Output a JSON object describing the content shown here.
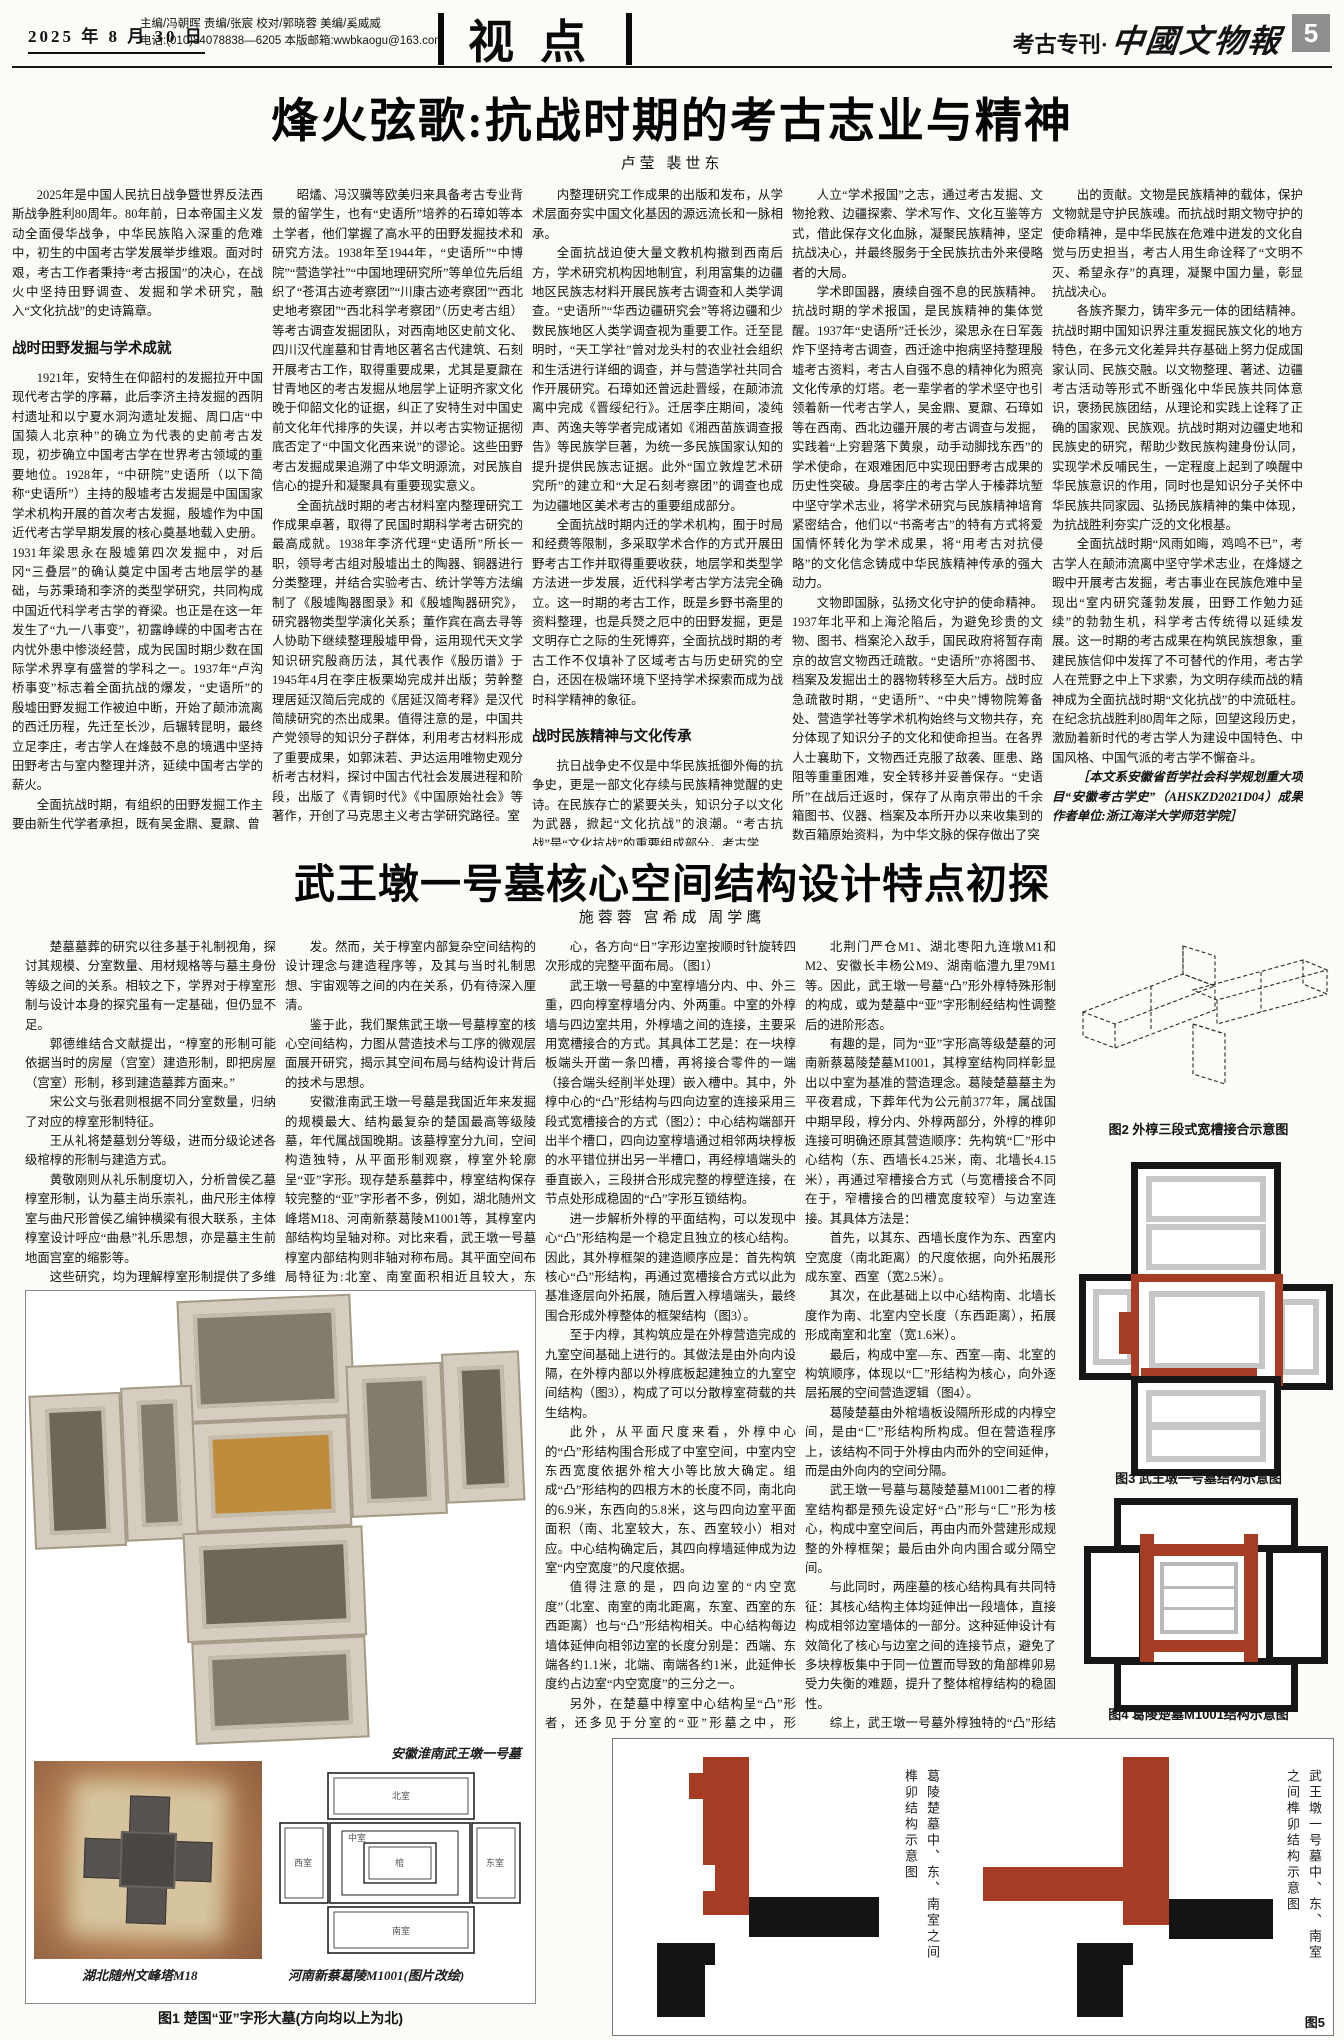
{
  "colors": {
    "accent_red": "#a63c24",
    "ink": "#131313",
    "page_badge_bg": "#8f8f8f"
  },
  "header": {
    "date": "2025 年 8 月 30 日",
    "editors": "主编/冯朝晖 责编/张宸 校对/郭晓蓉 美编/奚威威",
    "contact": "电话:(010)84078838—6205 本版邮箱:wwbkaogu@163.com",
    "section": "视点",
    "edition": "考古专刊·",
    "paper": "中國文物報",
    "page_no": "5"
  },
  "article1": {
    "title": "烽火弦歌:抗战时期的考古志业与精神",
    "authors": "卢莹  裴世东",
    "heading1": "战时田野发掘与学术成就",
    "heading2": "战时民族精神与文化传承",
    "c1": {
      "p1": "2025年是中国人民抗日战争暨世界反法西斯战争胜利80周年。80年前，日本帝国主义发动全面侵华战争，中华民族陷入深重的危难中，初生的中国考古学发展举步维艰。面对时艰，考古工作者秉持“考古报国”的决心，在战火中坚持田野调查、发掘和学术研究，融入“文化抗战”的史诗篇章。",
      "p2": "1921年，安特生在仰韶村的发掘拉开中国现代考古学的序幕，此后李济主持发掘的西阴村遗址和以宁夏水洞沟遗址发掘、周口店“中国猿人北京种”的确立为代表的史前考古发现，初步确立中国考古学在世界考古领域的重要地位。1928年，“中研院”史语所（以下简称“史语所”）主持的殷墟考古发掘是中国国家学术机构开展的首次考古发掘，殷墟作为中国近代考古学早期发展的核心奠基地载入史册。1931年梁思永在殷墟第四次发掘中，对后冈“三叠层”的确认奠定中国考古地层学的基础，与苏秉琦和李济的类型学研究，共同构成中国近代科学考古学的脊梁。也正是在这一年发生了“九一八事变”，初露峥嵘的中国考古在内忧外患中惨淡经营，成为民国时期少数在国际学术界享有盛誉的学科之一。1937年“卢沟桥事变”标志着全面抗战的爆发，“史语所”的殷墟田野发掘工作被迫中断，开始了颠沛流离的西迁历程，先迁至长沙，后辗转昆明，最终立足李庄，考古学人在烽鼓不息的境遇中坚持田野考古与室内整理并济，延续中国考古学的薪火。",
      "p3": "全面抗战时期，有组织的田野发掘工作主要由新生代学者承担，既有吴金鼎、夏鼐、曾"
    },
    "c2": {
      "p1": "昭燏、冯汉骥等欧美归来具备考古专业背景的留学生，也有“史语所”培养的石璋如等本土学者，他们掌握了高水平的田野发掘技术和研究方法。1938年至1944年，“史语所”“中博院”“营造学社”“中国地理研究所”等单位先后组织了“苍洱古迹考察团”“川康古迹考察团”“西北史地考察团”“西北科学考察团”（历史考古组）等考古调查发掘团队，对西南地区史前文化、四川汉代崖墓和甘青地区著名古代建筑、石刻开展考古工作，取得重要成果，尤其是夏鼐在甘青地区的考古发掘从地层学上证明齐家文化晚于仰韶文化的证据，纠正了安特生对中国史前文化年代排序的失误，并以考古实物证据彻底否定了“中国文化西来说”的谬论。这些田野考古发掘成果追溯了中华文明源流，对民族自信心的提升和凝聚具有重要现实意义。",
      "p2": "全面抗战时期的考古材料室内整理研究工作成果卓著，取得了民国时期科学考古研究的最高成就。1938年李济代理“史语所”所长一职，领导考古组对殷墟出土的陶器、铜器进行分类整理，并结合实验考古、统计学等方法编制了《殷墟陶器图录》和《殷墟陶器研究》，研究器物类型学演化关系；董作宾在高去寻等人协助下继续整理殷墟甲骨，运用现代天文学知识研究殷商历法，其代表作《殷历谱》于1945年4月在李庄板栗坳完成并出版；劳幹整理居延汉简后完成的《居延汉简考释》是汉代简牍研究的杰出成果。值得注意的是，中国共产党领导的知识分子群体，利用考古材料形成了重要成果，如郭沫若、尹达运用唯物史观分析考古材料，探讨中国古代社会发展进程和阶段，出版了《青铜时代》《中国原始社会》等著作，开创了马克思主义考古学研究路径。室"
    },
    "c3": {
      "p1": "内整理研究工作成果的出版和发布，从学术层面夯实中国文化基因的源远流长和一脉相承。",
      "p2": "全面抗战迫使大量文教机构撤到西南后方，学术研究机构因地制宜，利用富集的边疆地区民族志材料开展民族考古调查和人类学调查。“史语所”“华西边疆研究会”等将边疆和少数民族地区人类学调查视为重要工作。迁至昆明时，“天工学社”曾对龙头村的农业社会组织和生活进行详细的调查，并与营造学社共同合作开展研究。石璋如还曾远赴晋绥，在颠沛流离中完成《晋绥纪行》。迁居李庄期间，凌纯声、芮逸夫等学者完成诸如《湘西苗族调查报告》等民族学巨著，为统一多民族国家认知的提升提供民族志证据。此外“国立敦煌艺术研究所”的建立和“大足石刻考察团”的调查也成为边疆地区美术考古的重要组成部分。",
      "p3": "全面抗战时期内迁的学术机构，囿于时局和经费等限制，多采取学术合作的方式开展田野考古工作并取得重要收获，地层学和类型学方法进一步发展，近代科学考古学方法完全确立。这一时期的考古工作，既是乡野书斋里的资料整理，也是兵燹之厄中的田野发掘，更是文明存亡之际的生死博弈，全面抗战时期的考古工作不仅填补了区域考古与历史研究的空白，还因在极端环境下坚持学术探索而成为战时科学精神的象征。",
      "p4": "抗日战争史不仅是中华民族抵御外侮的抗争史，更是一部文化存续与民族精神觉醒的史诗。在民族存亡的紧要关头，知识分子以文化为武器，掀起“文化抗战”的浪潮。“考古抗战”是“文化抗战”的重要组成部分，考古学"
    },
    "c4": {
      "p1": "人立“学术报国”之志，通过考古发掘、文物抢救、边疆探索、学术写作、文化互鉴等方式，借此保存文化血脉，凝聚民族精神，坚定抗战决心，并最终服务于全民族抗击外来侵略者的大局。",
      "p2": "学术即国器，赓续自强不息的民族精神。抗战时期的学术报国，是民族精神的集体觉醒。1937年“史语所”迁长沙，梁思永在日军轰炸下坚持考古调查，西迁途中抱病坚持整理殷墟考古资料，考古人自强不息的精神化为照亮文化传承的灯塔。老一辈学者的学术坚守也引领着新一代考古学人，吴金鼎、夏鼐、石璋如等在西南、西北边疆开展的考古调查与发掘，实践着“上穷碧落下黄泉，动手动脚找东西”的学术使命，在艰难困厄中实现田野考古成果的历史性突破。身居李庄的考古学人于榛莽坑堑中坚守学术志业，将学术研究与民族精神培育紧密结合，他们以“书斋考古”的特有方式将爱国情怀转化为学术成果，将“用考古对抗侵略”的文化信念铸成中华民族精神传承的强大动力。",
      "p3": "文物即国脉，弘扬文化守护的使命精神。1937年北平和上海沦陷后，为避免珍贵的文物、图书、档案沦入敌手，国民政府将暂存南京的故宫文物西迁疏散。“史语所”亦将图书、档案及发掘出土的器物转移至大后方。战时应急疏散时期，“史语所”、“中央”博物院筹备处、营造学社等学术机构始终与文物共存，充分体现了知识分子的文化和使命担当。在各界人士襄助下，文物西迁克服了敌袭、匪患、路阻等重重困难，安全转移并妥善保存。“史语所”在战后迁返时，保存了从南京带出的千余箱图书、仪器、档案及本所开办以来收集到的数百箱原始资料，为中华文脉的保存做出了突"
    },
    "c5": {
      "p1": "出的贡献。文物是民族精神的载体，保护文物就是守护民族魂。而抗战时期文物守护的使命精神，是中华民族在危难中迸发的文化自觉与历史担当，考古人用生命诠释了“文明不灭、希望永存”的真理，凝聚中国力量，彰显抗战决心。",
      "p2": "各族齐聚力，铸牢多元一体的团结精神。抗战时期中国知识界注重发掘民族文化的地方特色，在多元文化差异共存基础上努力促成国家认同、民族交融。以文物整理、著述、边疆考古活动等形式不断强化中华民族共同体意识，褒扬民族团结，从理论和实践上诠释了正确的国家观、民族观。抗战时期对边疆史地和民族史的研究，帮助少数民族构建身份认同，实现学术反哺民生，一定程度上起到了唤醒中华民族意识的作用，同时也是知识分子关怀中华民族共同家园、弘扬民族精神的集中体现，为抗战胜利夯实广泛的文化根基。",
      "p3": "全面抗战时期“风雨如晦，鸡鸣不已”，考古学人在颠沛流离中坚守学术志业，在烽燧之暇中开展考古发掘，考古事业在民族危难中呈现出“室内研究蓬勃发展，田野工作勉力延续”的勃勃生机，科学考古传统得以延续发展。这一时期的考古成果在构筑民族想象，重建民族信仰中发挥了不可替代的作用，考古学人在荒野之中上下求索，为文明存续而战的精神成为全面抗战时期“文化抗战”的中流砥柱。在纪念抗战胜利80周年之际，回望这段历史，激励着新时代的考古学人为建设中国特色、中国风格、中国气派的考古学不懈奋斗。",
      "note": "［本文系安徽省哲学社会科学规划重大项目“安徽考古学史”（AHSKZD2021D04）成果　作者单位:浙江海洋大学师范学院］"
    }
  },
  "article2": {
    "title": "武王墩一号墓核心空间结构设计特点初探",
    "authors": "施蓉蓉 宫希成 周学鹰",
    "c1": {
      "p1": "楚墓墓葬的研究以往多基于礼制视角，探讨其规模、分室数量、用材规格等与墓主身份等级之间的关系。相较之下，学界对于椁室形制与设计本身的探究虽有一定基础，但仍显不足。",
      "p2": "郭德维结合文献提出，“椁室的形制可能依据当时的房屋（宫室）建造形制，即把房屋（宫室）形制，移到建造墓葬方面来。”",
      "p3": "宋公文与张君则根据不同分室数量，归纳了对应的椁室形制特征。",
      "p4": "王从礼将楚墓划分等级，进而分级论述各级棺椁的形制与建造方式。",
      "p5": "黄敬刚则从礼乐制度切入，分析曾侯乙墓椁室形制，认为墓主尚乐崇礼，曲尺形主体椁室与曲尺形曾侯乙编钟横梁有很大联系，主体椁室设计呼应“曲悬”礼乐思想，亦是墓主生前地面宫室的缩影等。",
      "p6": "这些研究，均为理解椁室形制提供了多维启"
    },
    "c2": {
      "p1": "发。然而，关于椁室内部复杂空间结构的设计理念与建造程序等，及其与当时礼制思想、宇宙观等之间的内在关系，仍有待深入厘清。",
      "p2": "鉴于此，我们聚焦武王墩一号墓椁室的核心空间结构，力图从营造技术与工序的微观层面展开研究，揭示其空间布局与结构设计背后的技术与思想。",
      "p3": "安徽淮南武王墩一号墓是我国近年来发掘的规模最大、结构最复杂的楚国最高等级陵墓，年代属战国晚期。该墓椁室分九间，空间构造独特，从平面形制观察，椁室外轮廓呈“亚”字形。现存楚系墓葬中，椁室结构保存较完整的“亚”字形者不多，例如，湖北随州文峰塔M18、河南新蔡葛陵M1001等，其椁室内部结构均呈轴对称。对比来看，武王墩一号墓椁室内部结构则非轴对称布局。其平面空间布局特征为:北室、南室面积相近且较大，东室、西室面积相近且较小，整体可视为以中室为中"
    },
    "c3": {
      "p1": "心，各方向“日”字形边室按顺时针旋转四次形成的完整平面布局。（图1）",
      "p2": "武王墩一号墓的中室椁墙分内、中、外三重，四向椁室椁墙分内、外两重。中室的外椁墙与四边室共用，外椁墙之间的连接，主要采用宽槽接合的方式。其具体工艺是：在一块椁板端头开凿一条凹槽，再将接合零件的一端（接合端头经削半处理）嵌入槽中。其中，外椁中心的“凸”形结构与四向边室的连接采用三段式宽槽接合的方式（图2）：中心结构端部开出半个槽口，四向边室椁墙通过相邻两块椁板的水平错位拼出另一半槽口，再经椁墙端头的垂直嵌入，三段拼合形成完整的椁壁连接，在节点处形成稳固的“凸”字形互锁结构。",
      "p3": "进一步解析外椁的平面结构，可以发现中心“凸”形结构是一个稳定且独立的核心结构。因此，其外椁框架的建造顺序应是：首先构筑核心“凸”形结构，再通过宽槽接合方式以此为基准逐层向外拓展，随后置入椁墙端头，最终围合形成外椁整体的框架结构（图3）。",
      "p4": "至于内椁，其构筑应是在外椁营造完成的九室空间基础上进行的。其做法是由外向内设隔，在外椁内部以外椁底板起建独立的九室空间结构（图3），构成了可以分散椁室荷载的共生结构。",
      "p5": "此外，从平面尺度来看，外椁中心的“凸”形结构围合形成了中室空间，中室内空东西宽度依据外棺大小等比放大确定。组成“凸”形结构的四根方木的长度不同，南北向的6.9米，东西向的5.8米，这与四向边室平面面积（南、北室较大，东、西室较小）相对应。中心结构确定后，其四向椁墙延伸成为边室“内空宽度”的尺度依据。",
      "p6": "值得注意的是，四向边室的“内空宽度”（北室、南室的南北距离，东室、西室的东西距离）也与“凸”形结构相关。中心结构每边墙体延伸向相邻边室的长度分别是：西端、东端各约1.1米，北端、南端各约1米，此延伸长度约占边室“内空宽度”的三分之一。",
      "p7": "另外，在楚墓中椁室中心结构呈“凸”形者，还多见于分室的“亚”形墓之中，形成“匚”形椁室结构等，例如，湖北荆门包山M2、湖"
    },
    "c4": {
      "p1": "北荆门严仓M1、湖北枣阳九连墩M1和M2、安徽长丰杨公M9、湖南临澧九里79M1等。因此，武王墩一号墓“凸”形外椁特殊形制的构成，或为楚墓中“亚”字形制经结构性调整后的进阶形态。",
      "p2": "有趣的是，同为“亚”字形高等级楚墓的河南新蔡葛陵楚墓M1001，其椁室结构同样彰显出以中室为基准的营造理念。葛陵楚墓墓主为平夜君成，下葬年代为公元前377年，属战国中期早段，椁分内、外椁两部分，外椁的榫卯连接可明确还原其营造顺序：先构筑“匚”形中心结构（东、西墙长4.25米，南、北墙长4.15米），再通过窄槽接合方式（与宽槽接合不同在于，窄槽接合的凹槽宽度较窄）与边室连接。其具体方法是：",
      "p3": "首先，以其东、西墙长度作为东、西室内空宽度（南北距离）的尺度依据，向外拓展形成东室、西室（宽2.5米）。",
      "p4": "其次，在此基础上以中心结构南、北墙长度作为南、北室内空长度（东西距离），拓展形成南室和北室（宽1.6米）。",
      "p5": "最后，构成中室—东、西室—南、北室的构筑顺序，体现以“匚”形结构为核心，向外逐层拓展的空间营造逻辑（图4）。",
      "p6": "葛陵楚墓由外棺墙板设隔所形成的内椁空间，是由“匚”形结构所构成。但在营造程序上，该结构不同于外椁由内而外的空间延伸，而是由外向内的空间分隔。",
      "p7": "武王墩一号墓与葛陵楚墓M1001二者的椁室结构都是预先设定好“凸”形与“匚”形为核心，构成中室空间后，再由内而外营建形成规整的外椁框架；最后由外向内围合或分隔空间。",
      "p8": "与此同时，两座墓的核心结构具有共同特征：其核心结构主体均延伸出一段墙体，直接构成相邻边室墙体的一部分。这种延伸设计有效简化了核心与边室之间的连接节点，避免了多块椁板集中于同一位置而导致的角部榫卯易受力失衡的难题，提升了整体棺椁结构的稳固性。",
      "p9": "综上，武王墩一号墓外椁独特的“凸”形结构和边室三段式宽槽接合工艺，不仅代表了战国晚期木作技艺的高超水平，更清晰地展现了一种以预设核心框架为基准的空间设计方法。该理念通过确立稳定的核心结构，以其尺度为模数基准控制椁室规模，并主导由内而外的空间拓展序列，实现复杂椁室体系的精密构建。其棺椁形制深刻体现了楚人对椁室空间层级、结构、秩序的思考与追求，彰显出楚国工匠的卓越技艺与精妙智慧。",
      "note": "（第一作者单位:南京大学历史学院;第二作者单位:安徽省文物考古研究所;第三作者单位:南京大学历史学院）"
    }
  },
  "figures": {
    "fig1": {
      "caption": "图1 楚国“亚”字形大墓(方向均以上为北)",
      "label_main": "安徽淮南武王墩一号墓",
      "label_left": "湖北随州文峰塔M18",
      "label_right": "河南新蔡葛陵M1001(图片改绘)",
      "plan_labels": {
        "north": "北室",
        "south": "南室",
        "west": "西室",
        "east": "东室",
        "center": "中室",
        "coffin": "棺"
      }
    },
    "fig2": {
      "caption": "图2 外椁三段式宽槽接合示意图"
    },
    "fig3": {
      "caption": "图3 武王墩一号墓结构示意图"
    },
    "fig4": {
      "caption": "图4 葛陵楚墓M1001结构示意图"
    },
    "fig5": {
      "caption": "图5",
      "label_left": "葛陵楚墓中、东、南室之间榫卯结构示意图",
      "label_right": "武王墩一号墓中、东、南室之间榫卯结构示意图"
    }
  }
}
